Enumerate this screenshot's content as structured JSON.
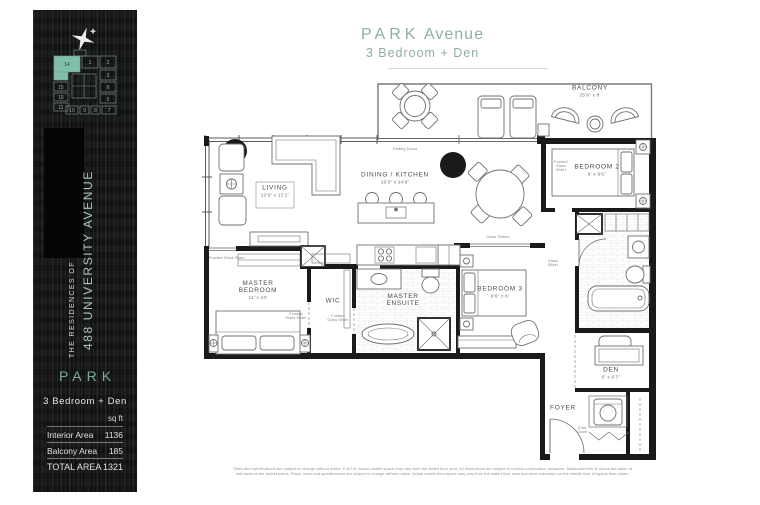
{
  "sidebar": {
    "building": {
      "prefix": "THE RESIDENCES OF",
      "name": "488 UNIVERSITY AVENUE"
    },
    "keyplate": {
      "highlighted_unit": "14",
      "units": [
        "14",
        "1",
        "2",
        "15",
        "3",
        "16",
        "6",
        "11",
        "5",
        "10",
        "9",
        "8",
        "7"
      ]
    },
    "plan": {
      "name": "PARK",
      "type": "3 Bedroom + Den",
      "unit_label": "sq ft",
      "areas": [
        {
          "label": "Interior Area",
          "value": "1136"
        },
        {
          "label": "Balcony Area",
          "value": "185"
        },
        {
          "label": "TOTAL AREA",
          "value": "1321"
        }
      ]
    }
  },
  "header": {
    "plan_name": "PARK",
    "plan_suffix": "Avenue",
    "subtitle": "3 Bedroom + Den"
  },
  "rooms": {
    "balcony": {
      "name": "BALCONY",
      "dims": "25'9\" x 8'"
    },
    "living": {
      "name": "LIVING",
      "dims": "12'9\" x 12'1\""
    },
    "dining_kitchen": {
      "name": "DINING / KITCHEN",
      "dims": "19'3\" x 14'9\""
    },
    "master_bedroom": {
      "name": "MASTER BEDROOM",
      "dims": "11' x 10'"
    },
    "wic": {
      "name": "WIC"
    },
    "master_ensuite": {
      "name": "MASTER ENSUITE"
    },
    "bedroom2": {
      "name": "BEDROOM 2",
      "dims": "9' x 9'6\""
    },
    "bedroom3": {
      "name": "BEDROOM 3",
      "dims": "9'6\" x 8'"
    },
    "den": {
      "name": "DEN",
      "dims": "6' x 6'7\""
    },
    "foyer": {
      "name": "FOYER"
    }
  },
  "annotations": {
    "folding_doors": "Folding Doors",
    "frosted_glass_slider": "Frosted Glass Slider",
    "glass_sliders": "Glass Sliders",
    "glass_slider": "Glass Slider",
    "coat_closet": "Coat Closet"
  },
  "colors": {
    "accent_green": "#8fb0a0",
    "keyplate_highlight": "#7fc0aa",
    "sidebar_bg": "#161817"
  },
  "disclaimer": {
    "line1": "Sizes and specifications are subject to change without notice. E.&O.E. Actual usable space may vary from the stated floor area. All dimensions are subject to normal construction variances. Measurements of rooms are taken at",
    "line2": "wall faces at the widest points. Plans, sizes and specifications are subject to change without notice. Actual usable floor space may vary from the stated floor area and were calculated on the middle floor of typical floor plates."
  }
}
